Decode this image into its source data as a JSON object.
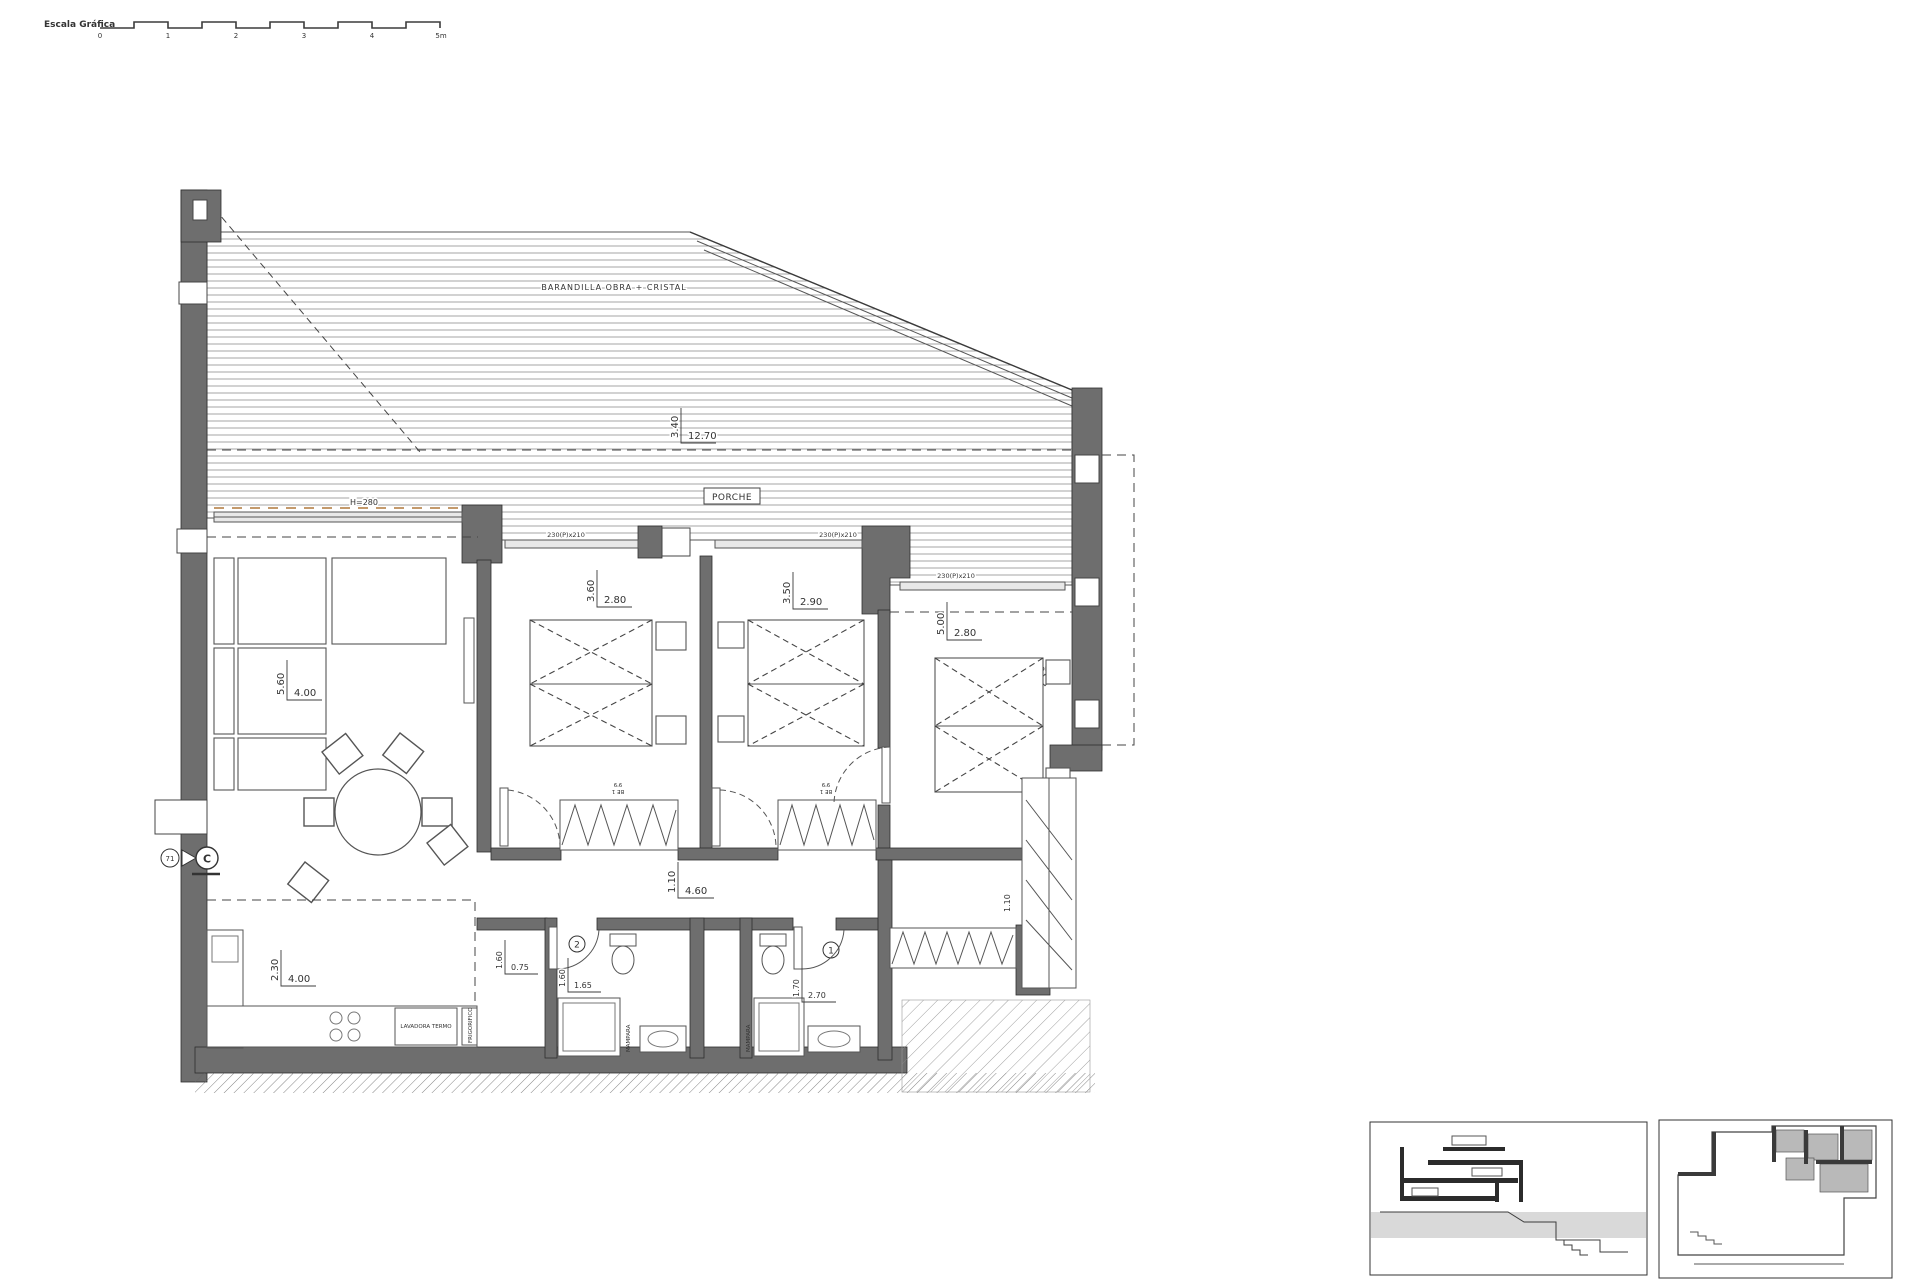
{
  "scale_bar": {
    "label": "Escala Gráfica",
    "ticks": [
      "0",
      "1",
      "2",
      "3",
      "4",
      "5m"
    ]
  },
  "terrace": {
    "railing_label": "BARANDILLA OBRA + CRISTAL",
    "porch_label": "PORCHE",
    "dim_vertical": "3.40",
    "dim_horizontal": "12.70",
    "water_point_label": "TOMA DE AGUA"
  },
  "living_room": {
    "dim_vertical": "5.60",
    "dim_horizontal": "4.00",
    "slider_label": "H=280"
  },
  "window_label": "230(P)x210",
  "bedroom_1": {
    "dim_vertical": "3.60",
    "dim_horizontal": "2.80"
  },
  "bedroom_2": {
    "dim_vertical": "3.50",
    "dim_horizontal": "2.90"
  },
  "bedroom_3": {
    "dim_vertical": "5.00",
    "dim_horizontal": "2.80"
  },
  "hallway": {
    "dim_vertical": "1.10",
    "dim_horizontal": "4.60"
  },
  "door_nook": {
    "dim_vertical": "1.60",
    "dim_horizontal": "0.75"
  },
  "bathroom_2": {
    "number": "2",
    "dim_vertical": "1.60",
    "dim_horizontal": "1.65",
    "shower_label": "MAMPARA"
  },
  "bathroom_1": {
    "number": "1",
    "dim_vertical": "1.70",
    "dim_horizontal": "2.70",
    "shower_label": "MAMPARA"
  },
  "kitchen": {
    "dim_vertical": "2.30",
    "dim_horizontal": "4.00",
    "appliance_1": "LAVADORA TERMO",
    "appliance_2": "FRIGORIFICO"
  },
  "wardrobe_label": {
    "line1": "BE 1",
    "line2": "9'9"
  },
  "laundry": {
    "dim_vertical": "1.10"
  },
  "section_marker": {
    "number": "71",
    "letter": "C"
  },
  "colors": {
    "wall": "#6e6e6e",
    "deck_line": "#8f8f8f",
    "sill_accent": "#c49a6c",
    "inset_ground": "#d9d9d9",
    "key_fill": "#b9b9b9"
  }
}
